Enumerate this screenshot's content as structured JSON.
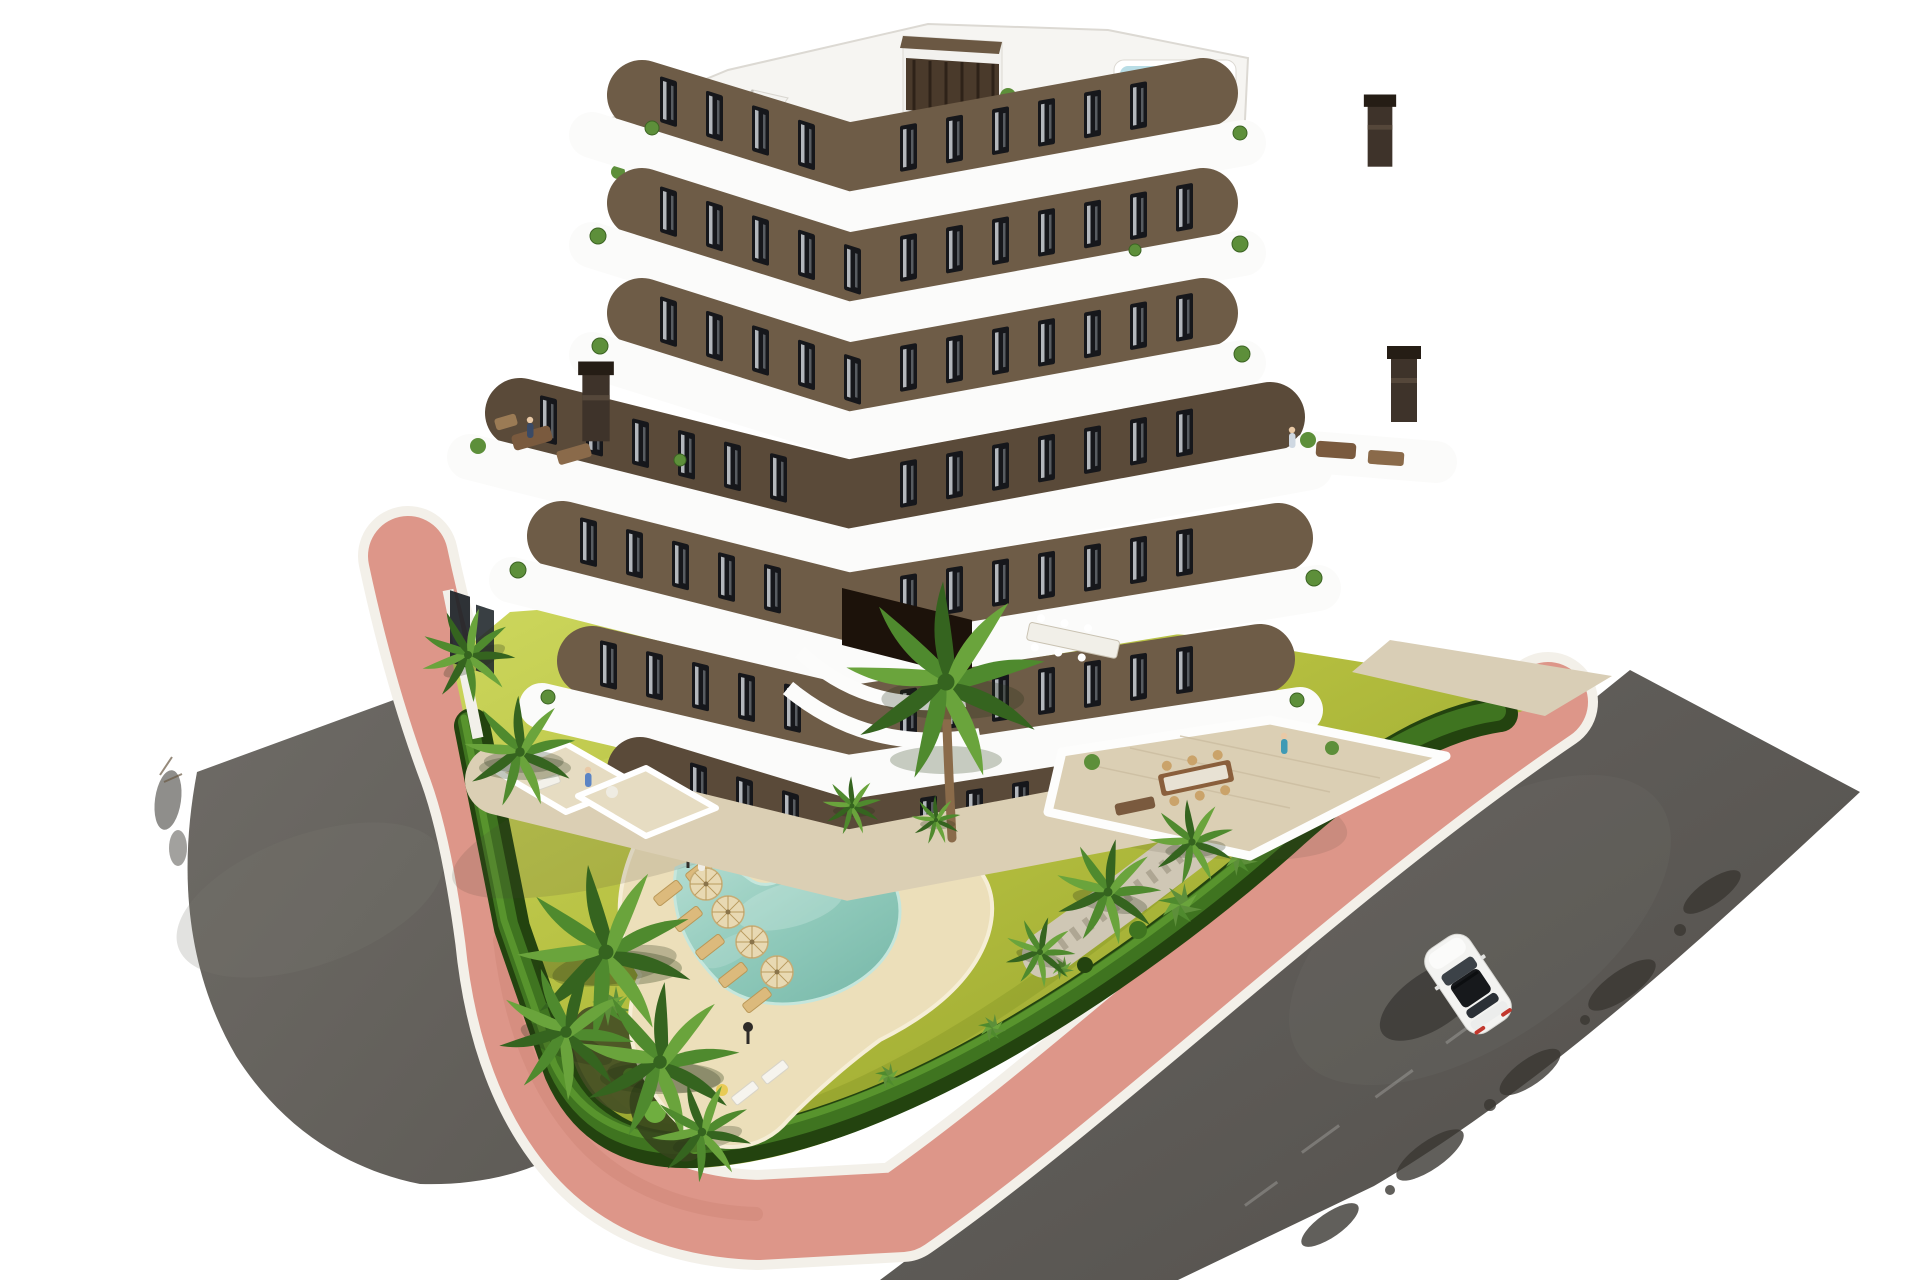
{
  "meta": {
    "description": "Aerial 3D architectural rendering of a modern six-storey apartment building with curved white balconies and brown facade, rooftop terrace with plunge pool, landscaped garden with lagoon-style pool, palm trees, salmon-pink paved walkway, asphalt roads and a white car",
    "canvas": {
      "width": 1920,
      "height": 1280
    },
    "style": "photorealistic CGI render on white background"
  },
  "colors": {
    "bg": "#ffffff",
    "roadL": "#6e6b66",
    "roadLd": "#5e5b56",
    "roadR": "#676460",
    "roadRd": "#524f4b",
    "pink": "#dd9689",
    "curb": "#f3f0e9",
    "lawn": "#b3bd3e",
    "lawnLight": "#cdd75d",
    "lawnDark": "#8a9a28",
    "hedgeDark": "#23430f",
    "hedgeMid": "#3f7420",
    "hedgeLight": "#5f9c31",
    "sand": "#ecdfba",
    "sandEdge": "#f6eed6",
    "water": "#8fc9ba",
    "waterDeep": "#76b7a8",
    "waterRim": "#c5e6dc",
    "island": "#ddd6c3",
    "mulch": "#424d24",
    "gravel": "#cfc7b5",
    "facade": "#6e5c47",
    "facadeDark": "#5a4a39",
    "band": "#fbfbfa",
    "roof": "#f6f5f2",
    "roofEdge": "#dcd9d3",
    "window": "#16171b",
    "curtain": "#cfd3d8",
    "apron": "#dbcfb4",
    "apronLine": "#c9bb9e",
    "chimney": "#3e332a",
    "slat": "#4a3a2b",
    "roofPool": "#b8dde6",
    "plantGreen": "#5d8f3a",
    "palmDark": "#35641f",
    "palmMid": "#4f8a2e",
    "palmLight": "#6aa43c",
    "trunk": "#8a6b4a",
    "furnDark": "#7a5a3e",
    "furnMid": "#8a6a4a",
    "furnWood": "#dcba7c",
    "furnWoodEdge": "#b99757",
    "carBody": "#f3f3f1",
    "carGlass": "#17191c",
    "carTail": "#c2382e"
  },
  "scene": {
    "building": {
      "type": "apartment block, V-shaped corner view",
      "storeys_visible": 7,
      "balcony_bands": 6,
      "facade": "dark warm brown with black-framed windows and white curtains",
      "features": [
        "curved white wrap-around balconies",
        "rooftop terrace with furniture",
        "rooftop plunge pool",
        "roof stair bulkhead with wooden slats",
        "external white staircase",
        "4 dark chimneys",
        "large stepped terraces with lounge furniture",
        "central courtyard with long dining table",
        "ground-floor tiled terraces"
      ]
    },
    "garden": {
      "lawn": "chartreuse green lawn",
      "hedge": "dark green trimmed perimeter hedge with white curb",
      "features": [
        "pebble planting island with small palms",
        "gravel bed with palms along right hedge",
        "yucca shrubs",
        "dark mulch bed at lower corner"
      ]
    },
    "pool": {
      "shape": "boomerang / lagoon style with sandy beach edge",
      "water": "turquoise",
      "deck": "cream sand-coloured deck",
      "umbrellas": 4,
      "sun_loungers": 8,
      "lamp_posts": 2
    },
    "vegetation": {
      "palm_trees": 12,
      "shrubs": "multiple"
    },
    "paths": {
      "walkway": "salmon-pink brick paved walkway with white curbs wrapping the plot"
    },
    "roads": {
      "left": "curved asphalt road",
      "right": "diagonal asphalt road with tyre marks and tree shadows"
    },
    "vehicles": [
      {
        "type": "coupe",
        "color": "white",
        "location": "right road",
        "heading": "upper-left",
        "details": "dark glass roof, red tail lights, shadow cast to the left"
      }
    ],
    "people_visible_approx": 12
  }
}
